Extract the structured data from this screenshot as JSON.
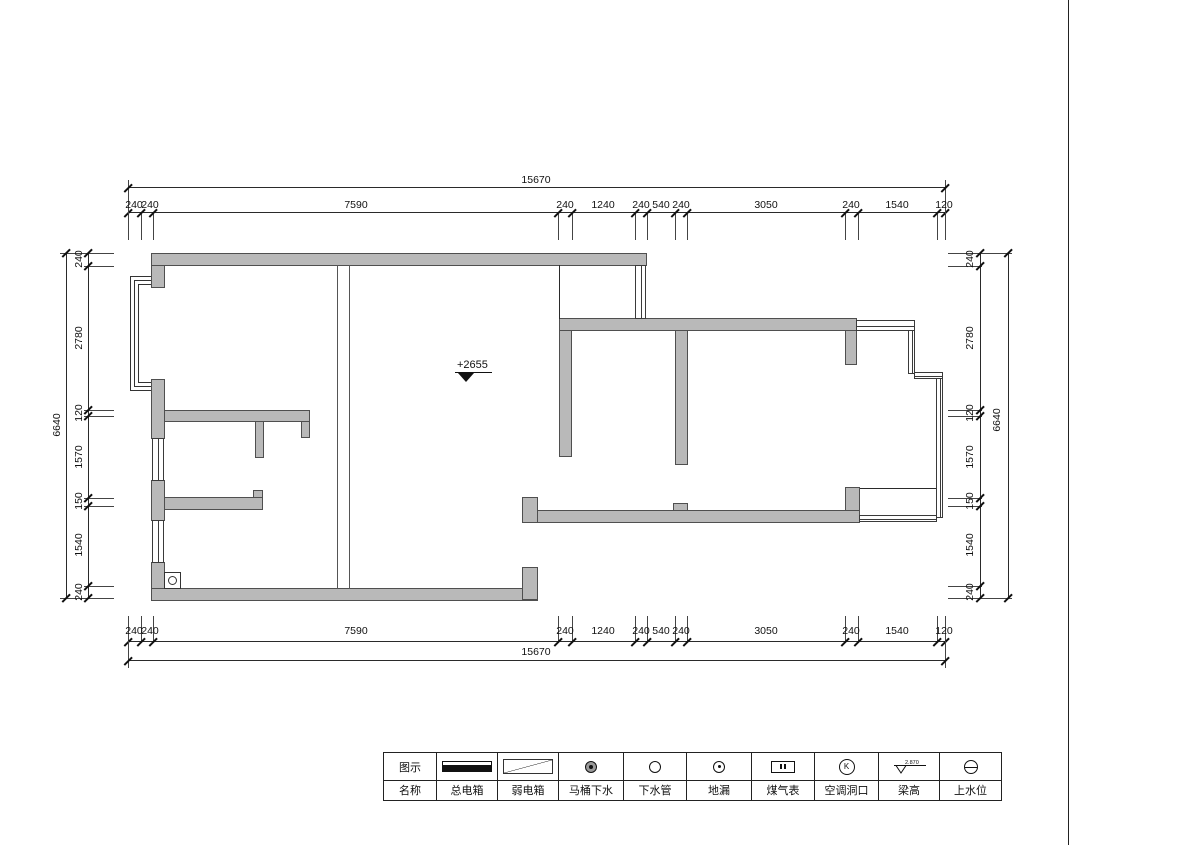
{
  "plan": {
    "elevation_note": "+2655",
    "dims": {
      "top_overall": "15670",
      "bottom_overall": "15670",
      "left_overall": "6640",
      "right_overall": "6640",
      "top_segments": [
        "240",
        "240",
        "7590",
        "240",
        "1240",
        "240",
        "540",
        "240",
        "3050",
        "240",
        "1540",
        "120"
      ],
      "bottom_segments": [
        "240",
        "240",
        "7590",
        "240",
        "1240",
        "240",
        "540",
        "240",
        "3050",
        "240",
        "1540",
        "120"
      ],
      "left_segments": [
        "240",
        "2780",
        "120",
        "1570",
        "150",
        "1540",
        "240"
      ],
      "right_segments": [
        "240",
        "2780",
        "120",
        "1570",
        "150",
        "1540",
        "240"
      ]
    }
  },
  "legend": {
    "row1_header": "图示",
    "row2_header": "名称",
    "items": [
      {
        "name": "总电箱",
        "symbol": "main-electric-box"
      },
      {
        "name": "弱电箱",
        "symbol": "weak-electric-box"
      },
      {
        "name": "马桶下水",
        "symbol": "toilet-drain"
      },
      {
        "name": "下水管",
        "symbol": "drain-pipe"
      },
      {
        "name": "地漏",
        "symbol": "floor-drain"
      },
      {
        "name": "煤气表",
        "symbol": "gas-meter"
      },
      {
        "name": "空调洞口",
        "symbol": "ac-hole",
        "letter": "K"
      },
      {
        "name": "梁高",
        "symbol": "beam-height",
        "value": "2.870"
      },
      {
        "name": "上水位",
        "symbol": "water-supply-level"
      }
    ]
  },
  "title_block": {
    "logo_text": "红牛装饰",
    "north_label": "N",
    "client_label": "CLIENT",
    "design_firm_label": "DESIGN FIRM",
    "design_firm_value": "南京红牛装饰",
    "project_label_1": "PROJECT",
    "project_address": "地址：龙蟠中路458号一层",
    "project_label_2": "PROJECT",
    "project_name": "一品嘉园",
    "revision_label": "REVISION",
    "date_label": "DATE",
    "by_label": "BY",
    "signed_off_label": "SIGNED OFF",
    "project_leader_label": "PROJECT LEADER",
    "checked_label": "CHECKED",
    "approved_label": "APPROVED",
    "project_designer_label": "PROJECT DESIGNER",
    "drawing_label": "DRAWING",
    "drawing_title_label": "DRAWING TITLE",
    "stage_label": "STAGE",
    "stage_value": "施工图纸",
    "scale_label": "SCALE",
    "scale_value": "1:100@A3",
    "date_label_2": "DATE",
    "date_value": "2024",
    "job_no_label": "JOB NO.",
    "drawing_no_label": "DRAWING NO.",
    "page_no_label": "PAGE NO."
  }
}
